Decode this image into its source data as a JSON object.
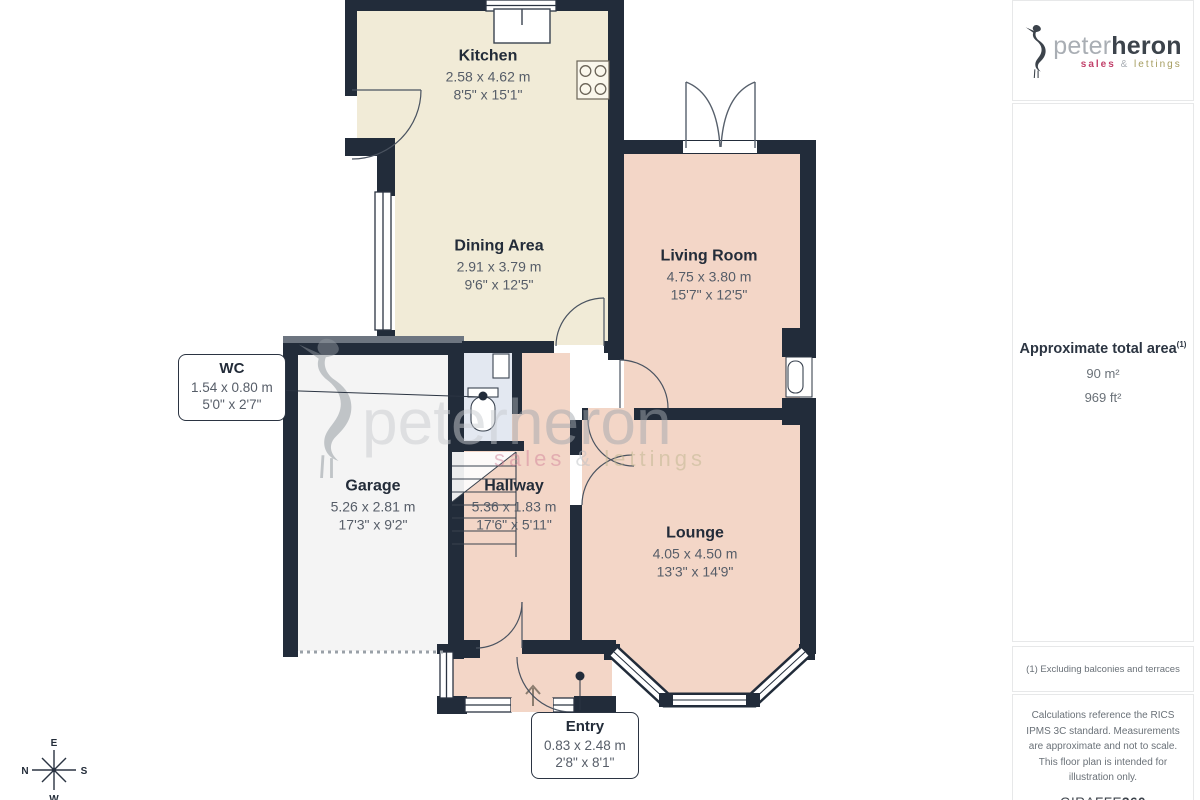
{
  "plan": {
    "rooms": [
      {
        "id": "kitchen",
        "name": "Kitchen",
        "metric": "2.58 x 4.62 m",
        "imperial": "8'5\" x 15'1\""
      },
      {
        "id": "dining",
        "name": "Dining Area",
        "metric": "2.91 x 3.79 m",
        "imperial": "9'6\" x 12'5\""
      },
      {
        "id": "living",
        "name": "Living Room",
        "metric": "4.75 x 3.80 m",
        "imperial": "15'7\" x 12'5\""
      },
      {
        "id": "wc",
        "name": "WC",
        "metric": "1.54 x 0.80 m",
        "imperial": "5'0\" x 2'7\""
      },
      {
        "id": "garage",
        "name": "Garage",
        "metric": "5.26 x 2.81 m",
        "imperial": "17'3\" x 9'2\""
      },
      {
        "id": "hallway",
        "name": "Hallway",
        "metric": "5.36 x 1.83 m",
        "imperial": "17'6\" x 5'11\""
      },
      {
        "id": "lounge",
        "name": "Lounge",
        "metric": "4.05 x 4.50 m",
        "imperial": "13'3\" x 14'9\""
      },
      {
        "id": "entry",
        "name": "Entry",
        "metric": "0.83 x 2.48 m",
        "imperial": "2'8\" x 8'1\""
      }
    ],
    "compass": {
      "top": "E",
      "left": "N",
      "right": "S",
      "bottom": "W"
    }
  },
  "watermark": {
    "light": "peter",
    "bold": "heron",
    "sales": "sales",
    "amp": " & ",
    "lettings": "lettings"
  },
  "brand": {
    "light": "peter",
    "bold": "heron",
    "sales": "sales",
    "amp": " & ",
    "lettings": "lettings"
  },
  "sidebar": {
    "area_title": "Approximate total area",
    "area_marker": "(1)",
    "area_sqm": "90 m²",
    "area_sqft": "969 ft²",
    "footnote": "(1) Excluding balconies and terraces",
    "disclaimer": "Calculations reference the RICS IPMS 3C standard. Measurements are approximate and not to scale. This floor plan is intended for illustration only.",
    "giraffe_name": "GIRAFFE",
    "giraffe_suffix": "360"
  },
  "colors": {
    "wall": "#222c3a",
    "wall_soft": "#6d7580",
    "cream": "#f1ebd7",
    "salmon": "#f3d6c7",
    "garage_floor": "#f4f4f4",
    "wc_blue": "#e3e8f1",
    "fixture": "#ffffff",
    "brand_pink": "#c2406a",
    "brand_olive": "#a59c5f",
    "label_dark": "#232c39",
    "label_gray": "#565d68"
  }
}
